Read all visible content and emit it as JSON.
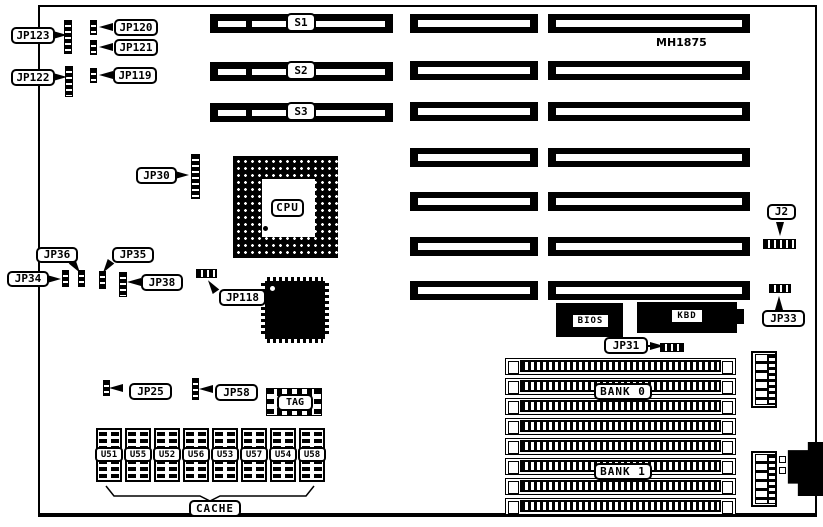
{
  "board": {
    "model": "MH1875"
  },
  "callouts": {
    "jp123": "JP123",
    "jp120": "JP120",
    "jp121": "JP121",
    "jp122": "JP122",
    "jp119": "JP119",
    "jp30": "JP30",
    "jp36": "JP36",
    "jp35": "JP35",
    "jp34": "JP34",
    "jp38": "JP38",
    "jp118": "JP118",
    "jp25": "JP25",
    "jp58": "JP58",
    "jp31": "JP31",
    "jp33": "JP33",
    "j2": "J2"
  },
  "slots": {
    "s1": "S1",
    "s2": "S2",
    "s3": "S3"
  },
  "chips": {
    "cpu": "CPU",
    "bios": "BIOS",
    "kbd": "KBD",
    "tag": "TAG"
  },
  "cache": {
    "chips": [
      "U51",
      "U55",
      "U52",
      "U56",
      "U53",
      "U57",
      "U54",
      "U58"
    ],
    "label": "CACHE"
  },
  "memory": {
    "bank0": "BANK 0",
    "bank1": "BANK 1"
  }
}
